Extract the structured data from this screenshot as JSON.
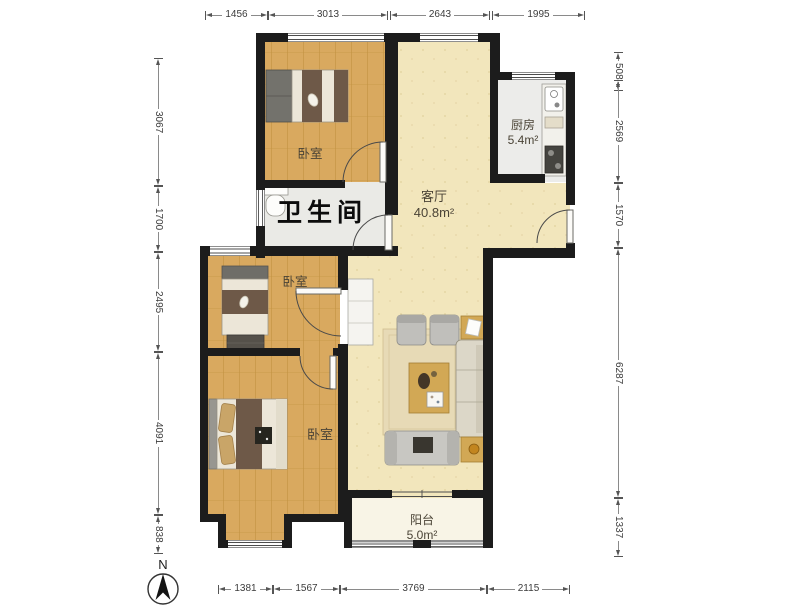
{
  "plan": {
    "title_hint": "apartment floor plan",
    "rooms": {
      "bedroom_top": {
        "label": "卧室"
      },
      "bathroom": {
        "label": "卫生间"
      },
      "living": {
        "label": "客厅",
        "area": "40.8m²"
      },
      "kitchen": {
        "label": "厨房",
        "area": "5.4m²"
      },
      "bedroom_middle": {
        "label": "卧室"
      },
      "bedroom_bottom": {
        "label": "卧室"
      },
      "balcony": {
        "label": "阳台",
        "area": "5.0m²"
      }
    },
    "compass": {
      "label": "N"
    },
    "dimensions": {
      "top": [
        "1456",
        "3013",
        "2643",
        "1995"
      ],
      "bottom": [
        "1381",
        "1567",
        "3769",
        "2115"
      ],
      "left": [
        "3067",
        "1700",
        "2495",
        "4091",
        "838"
      ],
      "right": [
        "508",
        "2569",
        "1570",
        "6287",
        "1337"
      ]
    },
    "colors": {
      "wall": "#1c1c1c",
      "wood_floor": "#d9a95f",
      "living_floor": "#f2e6bc",
      "tile_floor": "#ebebe8",
      "balcony_floor": "#f8f4e6",
      "dimension_text": "#3c3c3c"
    }
  }
}
